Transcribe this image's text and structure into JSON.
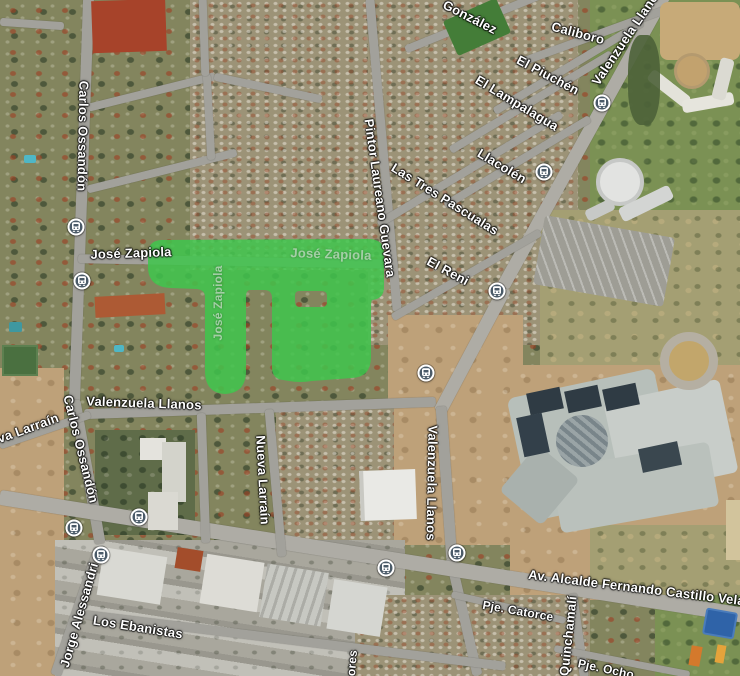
{
  "map": {
    "view_type": "satellite",
    "highlight": {
      "description": "highlighted neighborhood block at Jose Zapiola",
      "color": "#3fc64c",
      "opacity": 0.85
    },
    "street_labels": [
      {
        "text": "González",
        "x": 470,
        "y": 17,
        "rotate": 27,
        "style": "bright",
        "size": 13
      },
      {
        "text": "Caliboro",
        "x": 578,
        "y": 33,
        "rotate": 15,
        "style": "bright",
        "size": 13
      },
      {
        "text": "Valenzuela Llanos",
        "x": 627,
        "y": 36,
        "rotate": -56,
        "style": "bright",
        "size": 13
      },
      {
        "text": "El Piuchén",
        "x": 548,
        "y": 75,
        "rotate": 28,
        "style": "bright",
        "size": 13
      },
      {
        "text": "El Lampalagua",
        "x": 517,
        "y": 103,
        "rotate": 31,
        "style": "bright",
        "size": 13
      },
      {
        "text": "Llacolén",
        "x": 502,
        "y": 166,
        "rotate": 31,
        "style": "bright",
        "size": 13
      },
      {
        "text": "Las Tres Pascualas",
        "x": 445,
        "y": 199,
        "rotate": 32,
        "style": "bright",
        "size": 13
      },
      {
        "text": "El Reni",
        "x": 448,
        "y": 271,
        "rotate": 28,
        "style": "bright",
        "size": 13
      },
      {
        "text": "Pintor Laureano Guevara",
        "x": 380,
        "y": 198,
        "rotate": 82,
        "style": "bright",
        "size": 13
      },
      {
        "text": "Carlos Ossandón",
        "x": 83,
        "y": 136,
        "rotate": 91,
        "style": "bright",
        "size": 13
      },
      {
        "text": "Carlos Ossandón",
        "x": 81,
        "y": 449,
        "rotate": 76,
        "style": "bright",
        "size": 13
      },
      {
        "text": "José Zapiola",
        "x": 131,
        "y": 253,
        "rotate": -2,
        "style": "bright",
        "size": 13
      },
      {
        "text": "José Zapiola",
        "x": 331,
        "y": 254,
        "rotate": 2,
        "style": "muted",
        "size": 13
      },
      {
        "text": "José Zapiola",
        "x": 218,
        "y": 303,
        "rotate": -90,
        "style": "muted",
        "size": 12
      },
      {
        "text": "Valenzuela Llanos",
        "x": 144,
        "y": 403,
        "rotate": 2,
        "style": "bright",
        "size": 13
      },
      {
        "text": "Valenzuela Llanos",
        "x": 432,
        "y": 483,
        "rotate": 91,
        "style": "bright",
        "size": 13
      },
      {
        "text": "Nueva Larraín",
        "x": 263,
        "y": 480,
        "rotate": 87,
        "style": "bright",
        "size": 13
      },
      {
        "text": "va Larraín",
        "x": 28,
        "y": 428,
        "rotate": -20,
        "style": "bright",
        "size": 13
      },
      {
        "text": "Av. Alcalde Fernando Castillo Velasco",
        "x": 648,
        "y": 589,
        "rotate": 7,
        "style": "bright",
        "size": 13
      },
      {
        "text": "Los Ebanistas",
        "x": 138,
        "y": 627,
        "rotate": 9,
        "style": "bright",
        "size": 13
      },
      {
        "text": "Jorge Alessandri",
        "x": 79,
        "y": 615,
        "rotate": -74,
        "style": "bright",
        "size": 13
      },
      {
        "text": "Pje. Catorce",
        "x": 518,
        "y": 611,
        "rotate": 10,
        "style": "bright",
        "size": 12
      },
      {
        "text": "Quinchamalí",
        "x": 568,
        "y": 636,
        "rotate": -84,
        "style": "bright",
        "size": 13
      },
      {
        "text": "Pje. Ocho",
        "x": 606,
        "y": 669,
        "rotate": 12,
        "style": "bright",
        "size": 12
      },
      {
        "text": "ores",
        "x": 352,
        "y": 663,
        "rotate": -85,
        "style": "bright",
        "size": 12
      }
    ],
    "bus_stops": [
      {
        "x": 76,
        "y": 227
      },
      {
        "x": 82,
        "y": 281
      },
      {
        "x": 602,
        "y": 103
      },
      {
        "x": 544,
        "y": 172
      },
      {
        "x": 497,
        "y": 291
      },
      {
        "x": 426,
        "y": 373
      },
      {
        "x": 74,
        "y": 528
      },
      {
        "x": 139,
        "y": 517
      },
      {
        "x": 101,
        "y": 555
      },
      {
        "x": 386,
        "y": 568
      },
      {
        "x": 457,
        "y": 553
      }
    ],
    "colors": {
      "highlight_green": "#3fc64c",
      "label_white": "#ffffff",
      "label_muted": "rgba(228,236,228,0.62)",
      "bus_icon_fill": "#4a5a68",
      "road_gray": "#a2a19b"
    }
  }
}
